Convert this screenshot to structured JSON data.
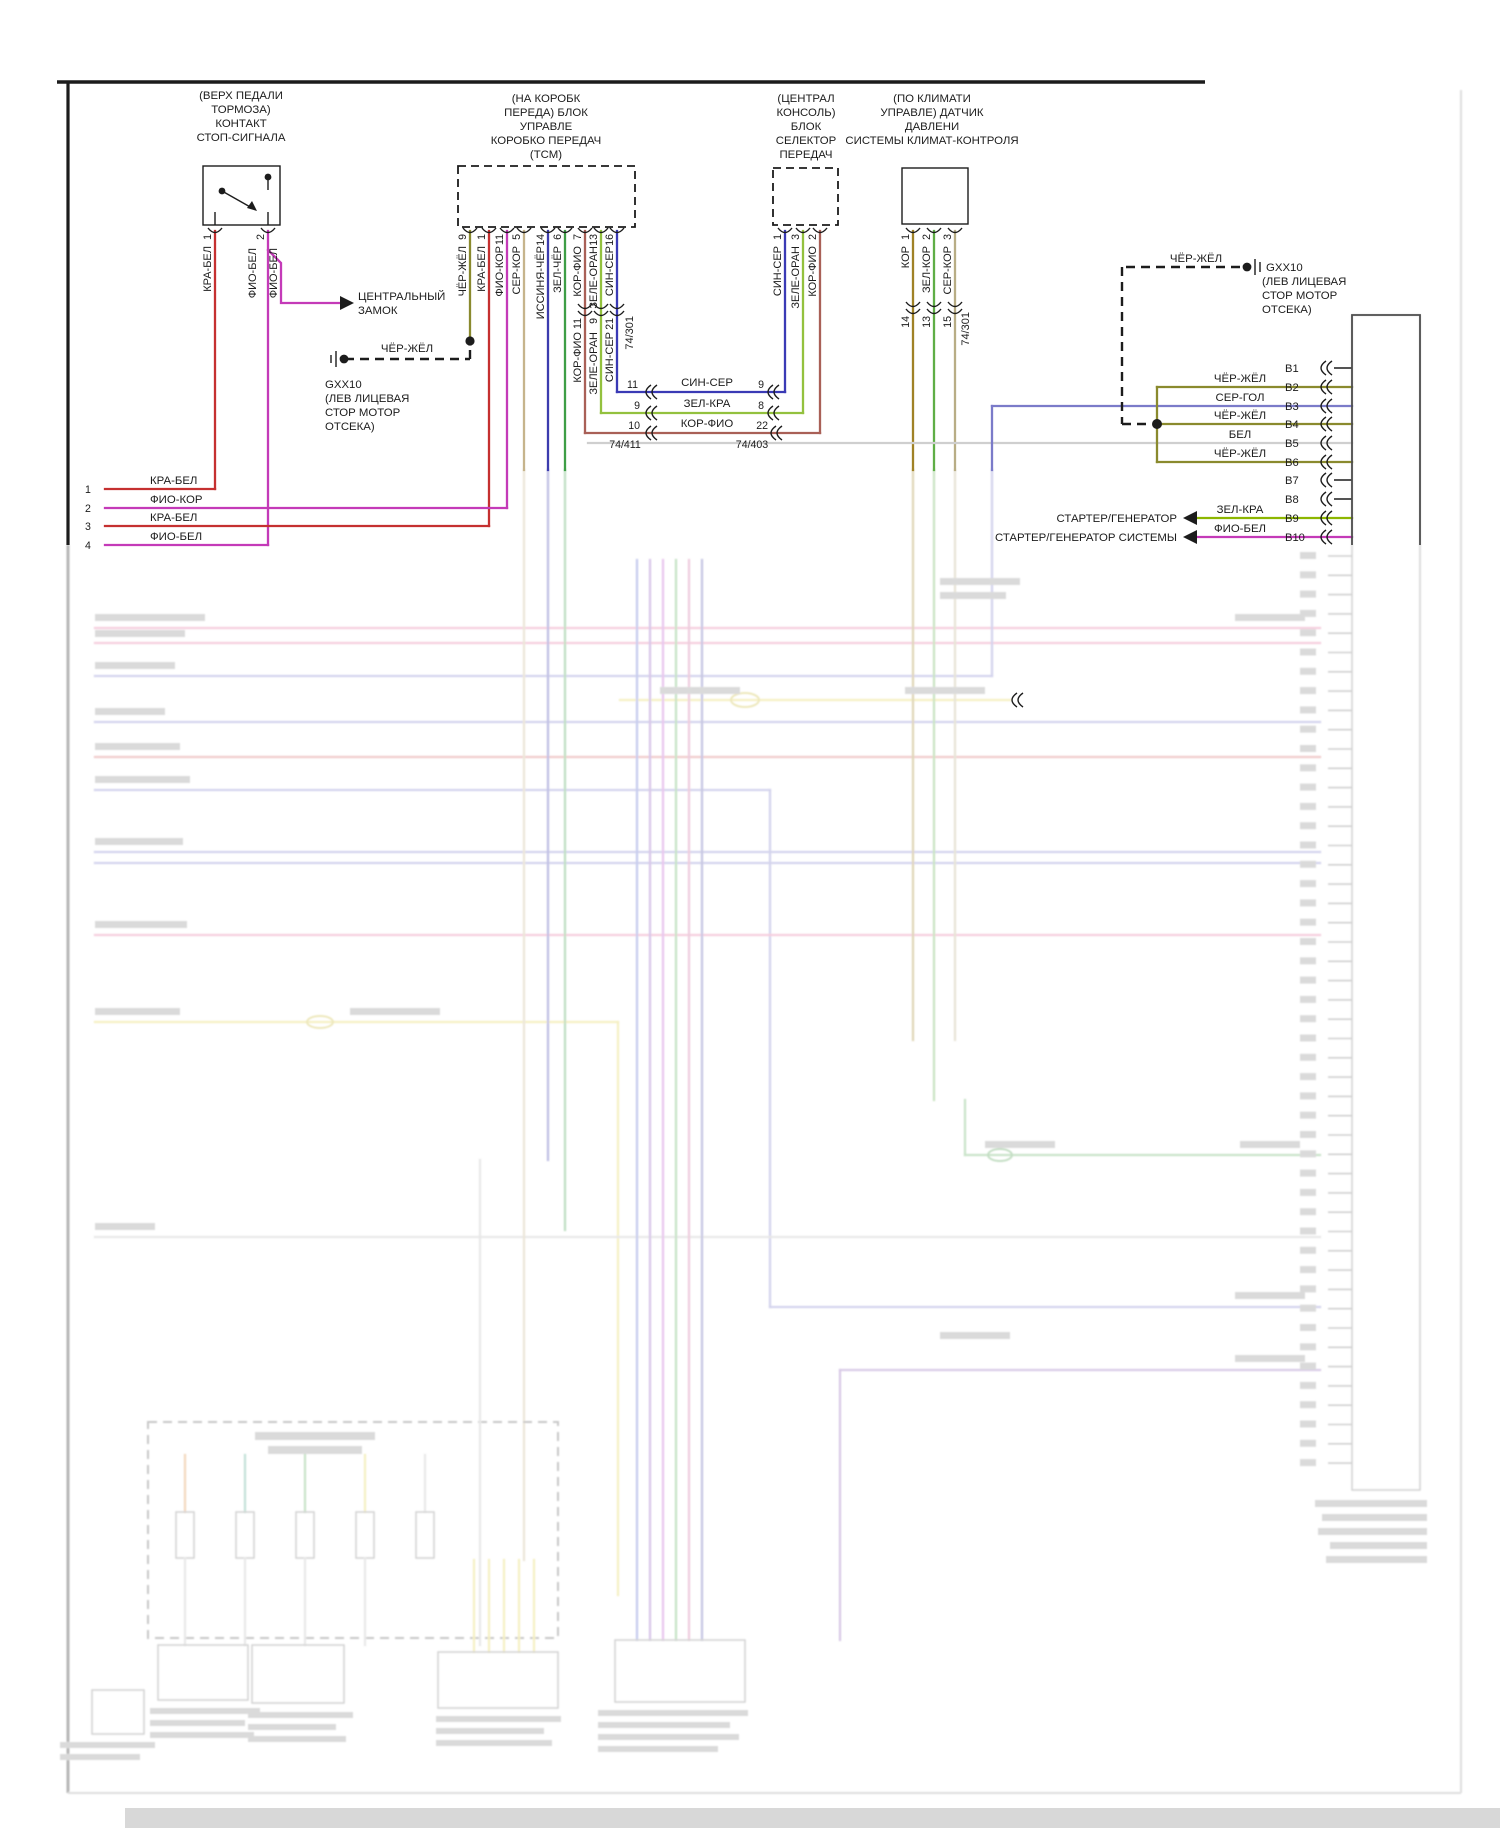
{
  "palette": {
    "red_white": "#c53030",
    "violet_white": "#c43ab8",
    "black_yellow": "#8a8a2e",
    "gray_brown": "#c6b48c",
    "blue_black": "#3c3cae",
    "green_black": "#3e9e46",
    "brown_violet": "#a96057",
    "green_orange": "#93c13e",
    "blue_gray": "#3a3ab5",
    "green_red": "#8db600",
    "gray_blue": "#7b7bc9",
    "white": "#cfcfcf",
    "brown": "#a08226",
    "green_brown": "#5fae46",
    "gray_brown2": "#b8ad85"
  },
  "brake_switch": {
    "title": [
      "(ВЕРХ ПЕДАЛИ",
      "ТОРМОЗА)",
      "КОНТАКТ",
      "СТОП-СИГНАЛА"
    ],
    "pin1": "1",
    "pin2": "2",
    "wire1": "КРА-БЕЛ",
    "wire2a": "ФИО-БЕЛ",
    "wire2b": "ФИО-БЕЛ"
  },
  "central_lock": {
    "line1": "ЦЕНТРАЛЬНЫЙ",
    "line2": "ЗАМОК"
  },
  "tcm": {
    "title": [
      "(НА КОРОБК",
      "ПЕРЕДА) БЛОК",
      "УПРАВЛЕ",
      "КОРОБКО ПЕРЕДАЧ",
      "(ТСМ)"
    ],
    "pins": [
      {
        "num": "9",
        "wire": "ЧЁР-ЖЁЛ"
      },
      {
        "num": "1",
        "wire": "КРА-БЕЛ"
      },
      {
        "num": "11",
        "wire": "ФИО-КОР"
      },
      {
        "num": "5",
        "wire": "СЕР-КОР"
      },
      {
        "num": "14",
        "wire": "ИССИНЯ-ЧЁР"
      },
      {
        "num": "6",
        "wire": "ЗЕЛ-ЧЁР"
      },
      {
        "num": "7",
        "wire": "КОР-ФИО"
      },
      {
        "num": "13",
        "wire": "ЗЕЛЕ-ОРАН"
      },
      {
        "num": "16",
        "wire": "СИН-СЕР"
      }
    ]
  },
  "tcm_splice": {
    "labels": [
      {
        "num": "11",
        "wire": "КОР-ФИО"
      },
      {
        "num": "9",
        "wire": "ЗЕЛЕ-ОРАН"
      },
      {
        "num": "21",
        "wire": "СИН-СЕР"
      }
    ],
    "connector": "74/301"
  },
  "selector": {
    "title": [
      "(ЦЕНТРАЛ",
      "КОНСОЛЬ)",
      "БЛОК",
      "СЕЛЕКТОР",
      "ПЕРЕДАЧ"
    ],
    "pins": [
      {
        "num": "1",
        "wire": "СИН-СЕР"
      },
      {
        "num": "3",
        "wire": "ЗЕЛЕ-ОРАН"
      },
      {
        "num": "2",
        "wire": "КОР-ФИО"
      }
    ]
  },
  "climate": {
    "title": [
      "(ПО КЛИМАТИ",
      "УПРАВЛЕ) ДАТЧИК",
      "ДАВЛЕНИ",
      "СИСТЕМЫ КЛИМАТ-КОНТРОЛЯ"
    ],
    "pins": [
      {
        "num": "1",
        "wire": "КОР",
        "num2": "14"
      },
      {
        "num": "2",
        "wire": "ЗЕЛ-КОР",
        "num2": "13"
      },
      {
        "num": "3",
        "wire": "СЕР-КОР",
        "num2": "15"
      }
    ],
    "connector": "74/301"
  },
  "splice_rows": [
    {
      "left": "11",
      "wire": "СИН-СЕР",
      "right": "9"
    },
    {
      "left": "9",
      "wire": "ЗЕЛ-КРА",
      "right": "8"
    },
    {
      "left": "10",
      "wire": "КОР-ФИО",
      "right": "22"
    }
  ],
  "connectors": {
    "c411": "74/411",
    "c403": "74/403"
  },
  "ground_left": {
    "wire": "ЧЁР-ЖЁЛ",
    "name": "GXX10",
    "loc": [
      "(ЛЕВ ЛИЦЕВАЯ",
      "СТОР МОТОР",
      "ОТСЕКА)"
    ]
  },
  "ground_right": {
    "wire": "ЧЁР-ЖЁЛ",
    "name": "GXX10",
    "loc": [
      "(ЛЕВ ЛИЦЕВАЯ",
      "СТОР МОТОР",
      "ОТСЕКА)"
    ]
  },
  "left_rows": [
    {
      "num": "1",
      "wire": "КРА-БЕЛ"
    },
    {
      "num": "2",
      "wire": "ФИО-КОР"
    },
    {
      "num": "3",
      "wire": "КРА-БЕЛ"
    },
    {
      "num": "4",
      "wire": "ФИО-БЕЛ"
    }
  ],
  "b_connector": {
    "rows": [
      {
        "pin": "B1",
        "wire": ""
      },
      {
        "pin": "B2",
        "wire": "ЧЁР-ЖЁЛ"
      },
      {
        "pin": "B3",
        "wire": "СЕР-ГОЛ"
      },
      {
        "pin": "B4",
        "wire": "ЧЁР-ЖЁЛ"
      },
      {
        "pin": "B5",
        "wire": "БЕЛ"
      },
      {
        "pin": "B6",
        "wire": "ЧЁР-ЖЁЛ"
      },
      {
        "pin": "B7",
        "wire": ""
      },
      {
        "pin": "B8",
        "wire": ""
      },
      {
        "pin": "B9",
        "wire": "ЗЕЛ-КРА"
      },
      {
        "pin": "B10",
        "wire": "ФИО-БЕЛ"
      }
    ]
  },
  "starter": {
    "row1": "СТАРТЕР/ГЕНЕРАТОР",
    "row2": "СТАРТЕР/ГЕНЕРАТОР СИСТЕМЫ"
  }
}
